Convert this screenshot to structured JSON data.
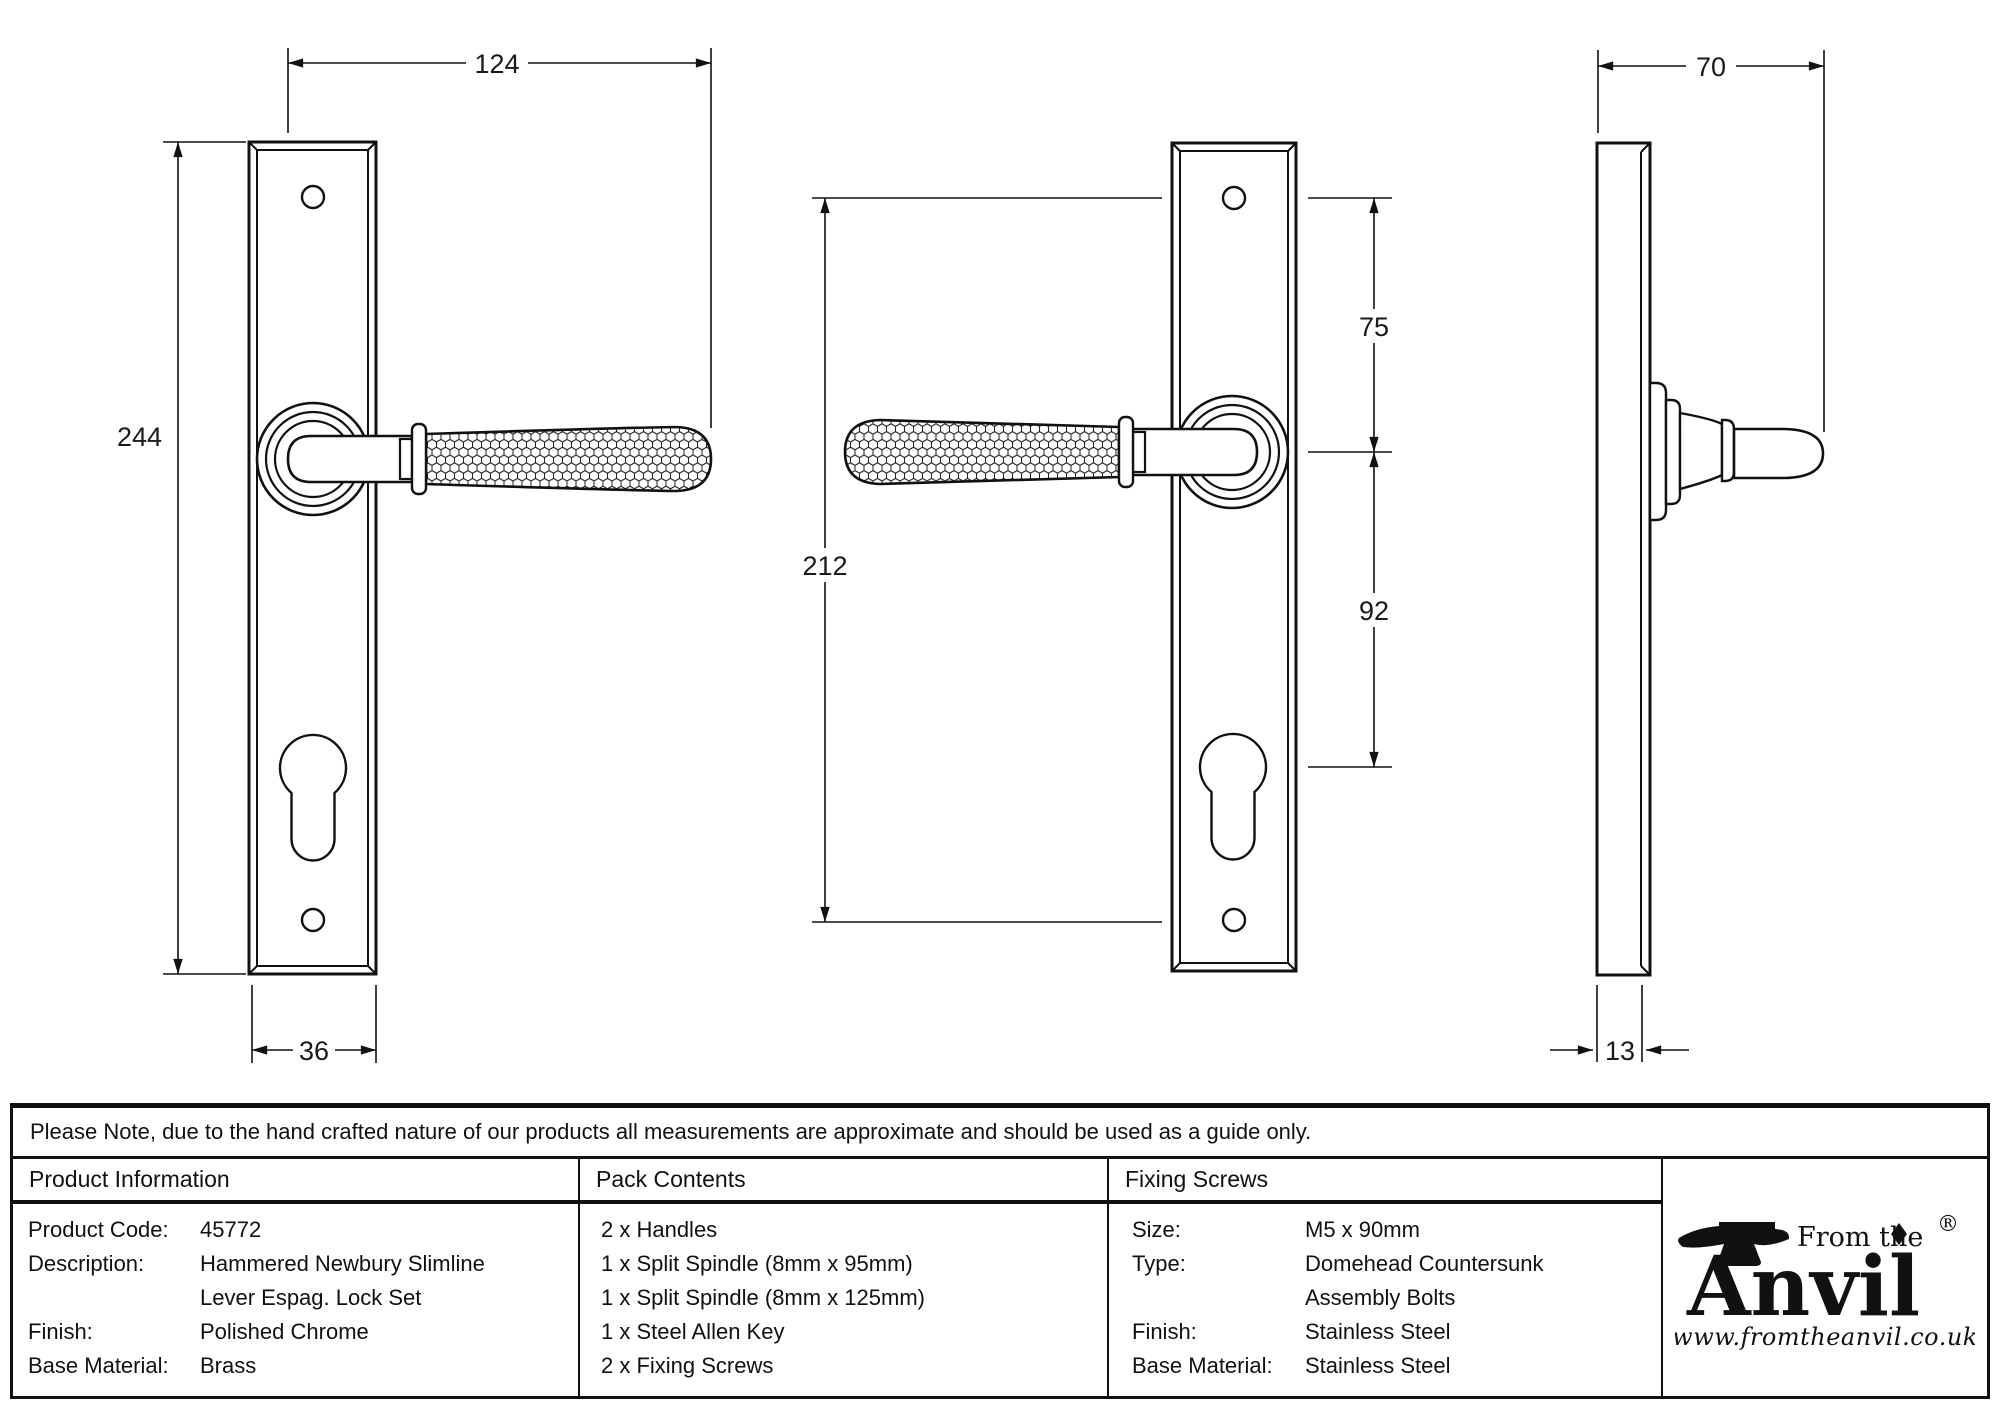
{
  "colors": {
    "ink": "#111111",
    "background": "#ffffff"
  },
  "drawings": {
    "front_left": {
      "name": "front view - lever right",
      "dims": {
        "length_overall": "124",
        "height": "244",
        "plate_width": "36"
      }
    },
    "front_mirrored": {
      "name": "front view - lever left",
      "dims": {
        "fixing_centres": "212",
        "screw_to_handle": "75",
        "handle_to_cylinder": "92"
      }
    },
    "side": {
      "name": "side profile",
      "dims": {
        "projection": "70",
        "plate_thickness": "13"
      }
    }
  },
  "note": "Please Note, due to the hand crafted nature of our products all measurements are approximate and should be used as a guide only.",
  "table": {
    "product_information": {
      "header": "Product Information",
      "rows": [
        {
          "label": "Product Code:",
          "value": "45772"
        },
        {
          "label": "Description:",
          "value": "Hammered Newbury Slimline"
        },
        {
          "label": "",
          "value": "Lever Espag. Lock Set"
        },
        {
          "label": "Finish:",
          "value": "Polished Chrome"
        },
        {
          "label": "Base Material:",
          "value": "Brass"
        }
      ]
    },
    "pack_contents": {
      "header": "Pack Contents",
      "items": [
        "2 x Handles",
        "1 x Split Spindle (8mm x 95mm)",
        "1 x Split Spindle (8mm x 125mm)",
        "1 x Steel Allen Key",
        "2 x Fixing Screws"
      ]
    },
    "fixing_screws": {
      "header": "Fixing Screws",
      "rows": [
        {
          "label": "Size:",
          "value": "M5 x 90mm"
        },
        {
          "label": "Type:",
          "value": "Domehead Countersunk"
        },
        {
          "label": "",
          "value": "Assembly Bolts"
        },
        {
          "label": "Finish:",
          "value": "Stainless Steel"
        },
        {
          "label": "Base Material:",
          "value": "Stainless Steel"
        }
      ]
    },
    "logo": {
      "top": "From the",
      "name": "Anvil",
      "reg": "®",
      "url": "www.fromtheanvil.co.uk"
    }
  }
}
